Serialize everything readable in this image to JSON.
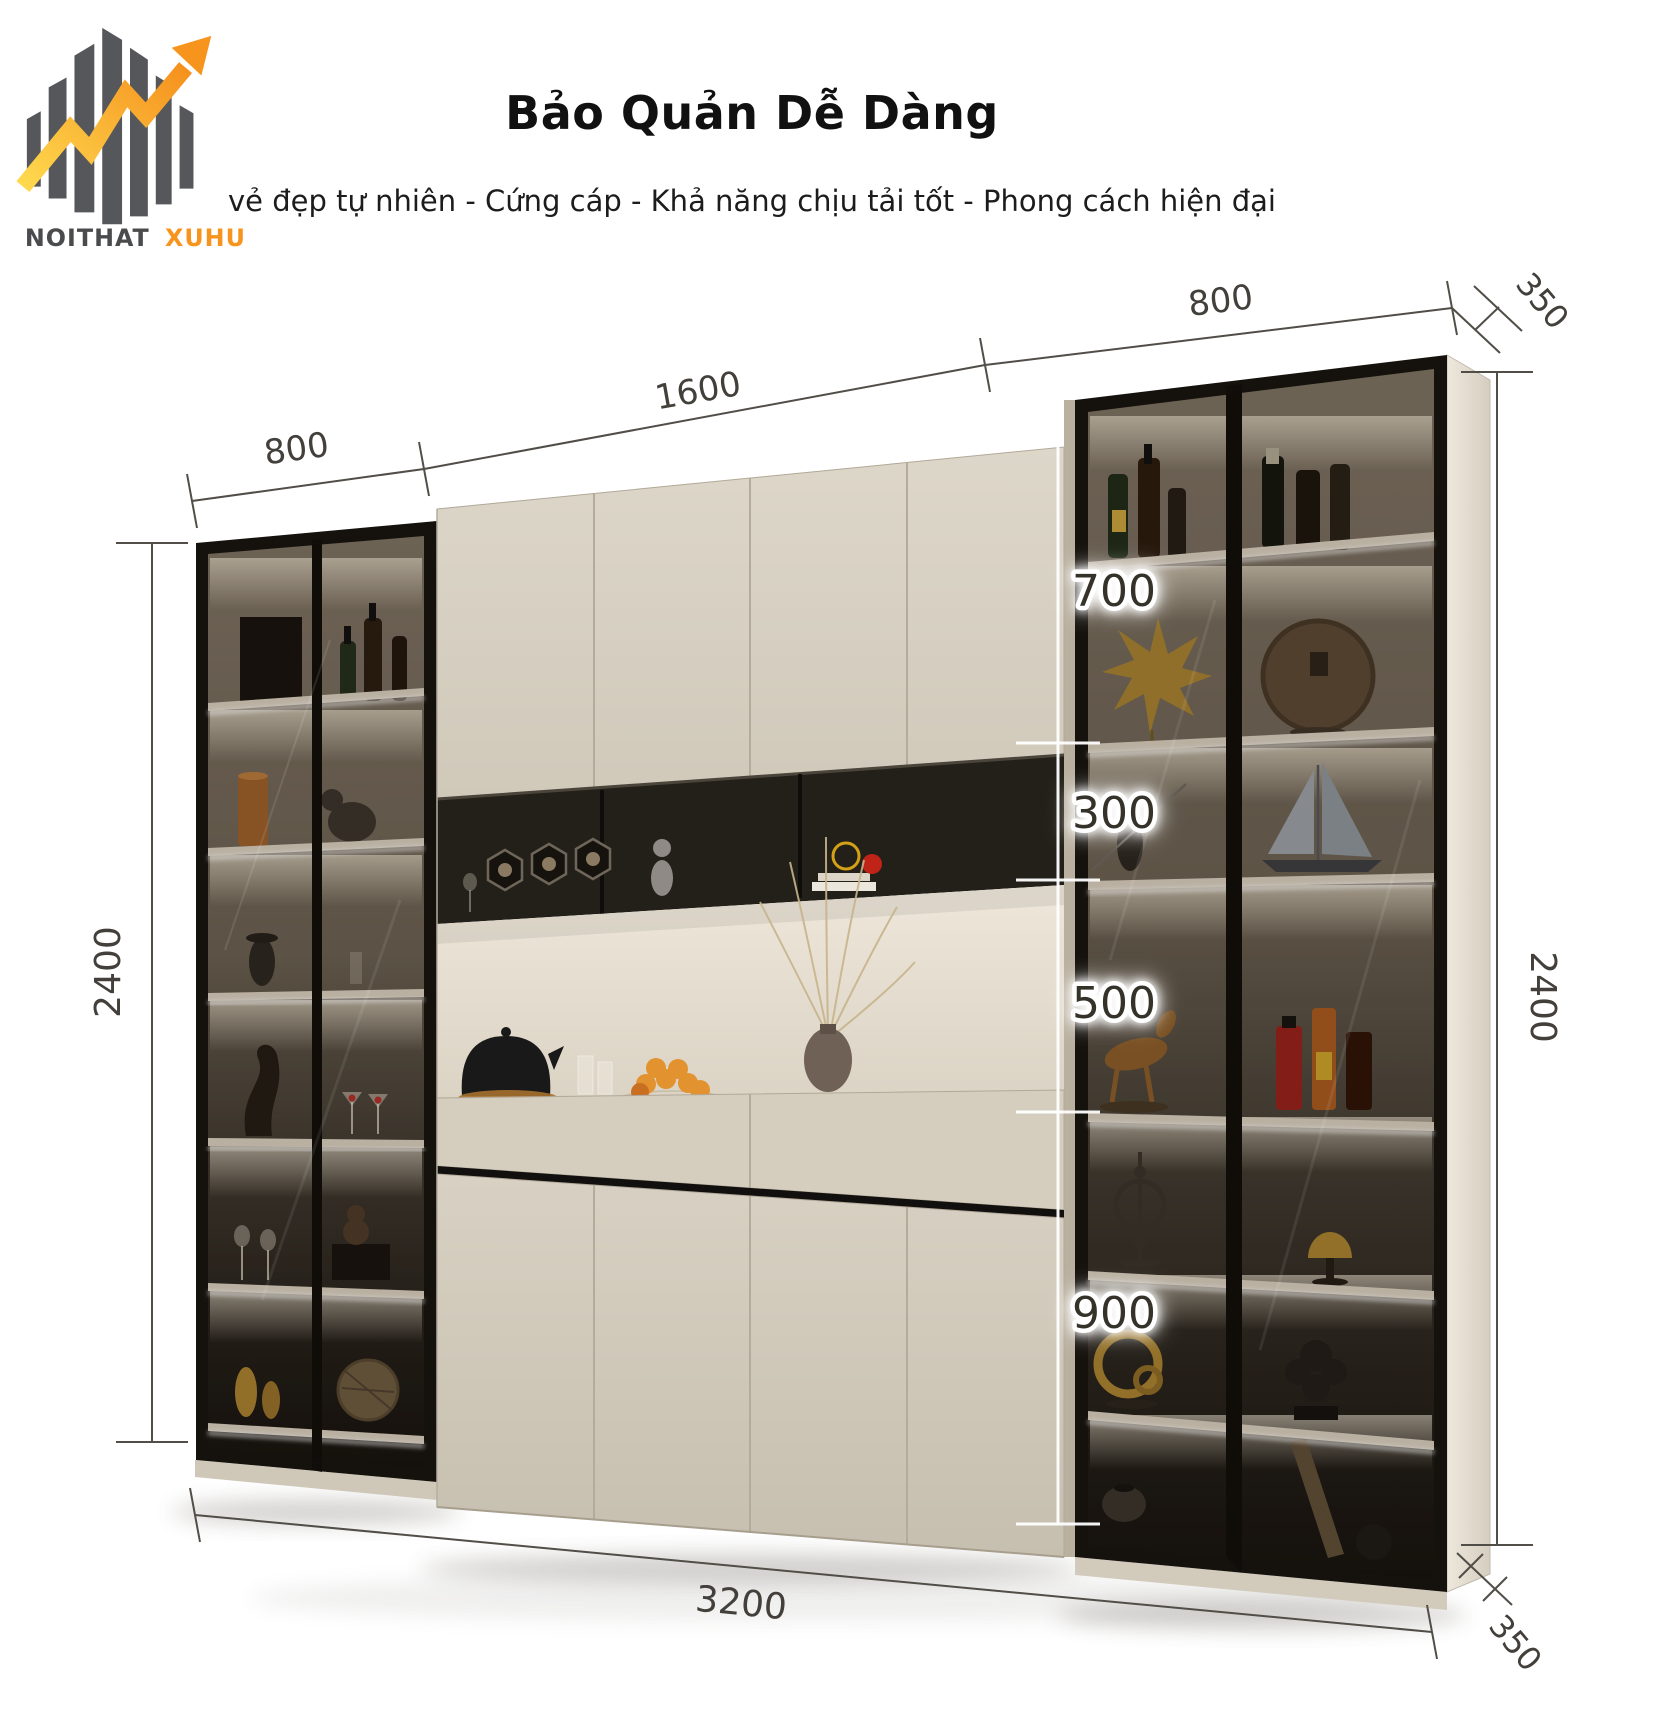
{
  "logo": {
    "brand_primary": "NOITHAT",
    "brand_accent": "XUHUONG",
    "accent_color": "#f7941d",
    "bar_color": "#56575b"
  },
  "header": {
    "title": "Bảo Quản Dễ Dàng",
    "subtitle": "vẻ đẹp tự nhiên - Cứng cáp - Khả năng chịu tải tốt - Phong cách hiện đại"
  },
  "diagram": {
    "product": "wall display cabinet",
    "dimensions": {
      "top_left_width": "800",
      "top_center_width": "1600",
      "top_right_width": "800",
      "top_depth": "350",
      "left_height": "2400",
      "right_height": "2400",
      "total_width": "3200",
      "bottom_depth": "350",
      "segments": [
        "700",
        "300",
        "500",
        "900"
      ]
    },
    "colors": {
      "cabinet_cream": "#d6cfc1",
      "frame_black": "#15110d",
      "dimension_text": "#433f3a"
    }
  }
}
